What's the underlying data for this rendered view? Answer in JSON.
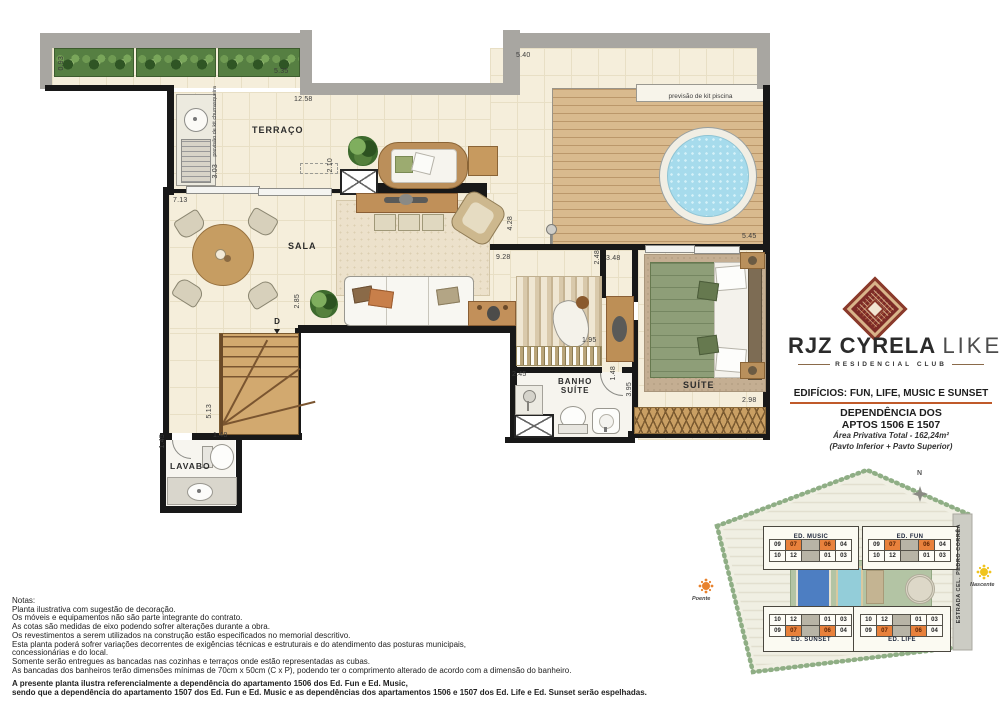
{
  "plan": {
    "rooms": {
      "terraco": "TERRAÇO",
      "sala": "SALA",
      "suite": "SUÍTE",
      "banho_suite": "BANHO\nSUÍTE",
      "lavabo": "LAVABO"
    },
    "annotations": {
      "churrasqueira": "previsão de kit churrasqueira",
      "piscina": "previsão de kit piscina",
      "door_marker": "D"
    },
    "dimensions": [
      {
        "text": "0.93",
        "x": 58,
        "y": 56,
        "v": true
      },
      {
        "text": "5.35",
        "x": 274,
        "y": 68
      },
      {
        "text": "12.58",
        "x": 294,
        "y": 96
      },
      {
        "text": "3.03",
        "x": 212,
        "y": 164,
        "v": true
      },
      {
        "text": "5.40",
        "x": 516,
        "y": 52
      },
      {
        "text": "2.10",
        "x": 327,
        "y": 158,
        "v": true
      },
      {
        "text": "7.13",
        "x": 173,
        "y": 197
      },
      {
        "text": "4.28",
        "x": 507,
        "y": 216,
        "v": true
      },
      {
        "text": "9.28",
        "x": 496,
        "y": 254
      },
      {
        "text": "2.48",
        "x": 594,
        "y": 250,
        "v": true
      },
      {
        "text": "3.48",
        "x": 606,
        "y": 255
      },
      {
        "text": "5.45",
        "x": 742,
        "y": 233
      },
      {
        "text": "2.85",
        "x": 294,
        "y": 294,
        "v": true
      },
      {
        "text": "1.95",
        "x": 582,
        "y": 337
      },
      {
        "text": "2.45",
        "x": 512,
        "y": 371
      },
      {
        "text": "1.48",
        "x": 610,
        "y": 366,
        "v": true
      },
      {
        "text": "3.95",
        "x": 626,
        "y": 382,
        "v": true
      },
      {
        "text": "2.98",
        "x": 742,
        "y": 397
      },
      {
        "text": "5.13",
        "x": 206,
        "y": 404,
        "v": true
      },
      {
        "text": "1.45",
        "x": 159,
        "y": 434,
        "v": true
      },
      {
        "text": "1.48",
        "x": 213,
        "y": 432
      }
    ]
  },
  "branding": {
    "title_main": "RJZ CYRELA",
    "title_light": "LIKE",
    "subtitle": "RESIDENCIAL CLUB",
    "edificios": "EDIFÍCIOS:  FUN, LIFE, MUSIC E SUNSET",
    "dependencia_line1": "DEPENDÊNCIA DOS",
    "dependencia_line2": "APTOS 1506 E 1507",
    "area": "Área Privativa Total - 162,24m²",
    "pavimentos": "(Pavto Inferior + Pavto Superior)"
  },
  "colors": {
    "accent_orange": "#c05a2a",
    "logo_red": "#7d2b27",
    "highlight_unit": "#e8813c"
  },
  "notes": {
    "title": "Notas:",
    "lines": [
      "Planta ilustrativa com sugestão de decoração.",
      "Os móveis e equipamentos não são parte integrante do contrato.",
      "As cotas são  medidas  de  eixo podendo sofrer alterações durante a obra.",
      "Os revestimentos a serem utilizados na construção estão especificados no memorial descritivo.",
      "Esta planta poderá sofrer variações decorrentes de exigências técnicas e estruturais e do atendimento das posturas municipais,",
      "concessionárias e do local.",
      "Somente serão entregues as bancadas nas cozinhas e terraços onde estão representadas as cubas.",
      "As bancadas dos banheiros terão dimensões mínimas de 70cm x 50cm (C x P), podendo ter o comprimento alterado de acordo com a dimensão do banheiro."
    ],
    "bold_lines": [
      "A presente planta ilustra referencialmente a dependência do apartamento 1506 dos Ed. Fun e Ed. Music,",
      "sendo que a dependência do apartamento 1507 dos Ed. Fun e Ed. Music e as dependências dos apartamentos 1506 e 1507 dos Ed. Life e Ed. Sunset serão espelhadas."
    ]
  },
  "siteplan": {
    "compass": "N",
    "west_label": "Poente",
    "east_label": "Nascente",
    "road": "ESTRADA CEL. PEDRO CORRÊA",
    "highlight_units": [
      "07",
      "06"
    ],
    "buildings": [
      {
        "name": "ED. MUSIC",
        "label_pos": "top",
        "rows": [
          [
            "09",
            "07",
            "06",
            "04"
          ],
          [
            "10",
            "12",
            "01",
            "03"
          ]
        ]
      },
      {
        "name": "ED. FUN",
        "label_pos": "top",
        "rows": [
          [
            "09",
            "07",
            "06",
            "04"
          ],
          [
            "10",
            "12",
            "01",
            "03"
          ]
        ]
      },
      {
        "name": "ED. SUNSET",
        "label_pos": "bottom",
        "rows": [
          [
            "10",
            "12",
            "01",
            "03"
          ],
          [
            "09",
            "07",
            "06",
            "04"
          ]
        ]
      },
      {
        "name": "ED. LIFE",
        "label_pos": "bottom",
        "rows": [
          [
            "10",
            "12",
            "01",
            "03"
          ],
          [
            "09",
            "07",
            "06",
            "04"
          ]
        ]
      }
    ]
  }
}
